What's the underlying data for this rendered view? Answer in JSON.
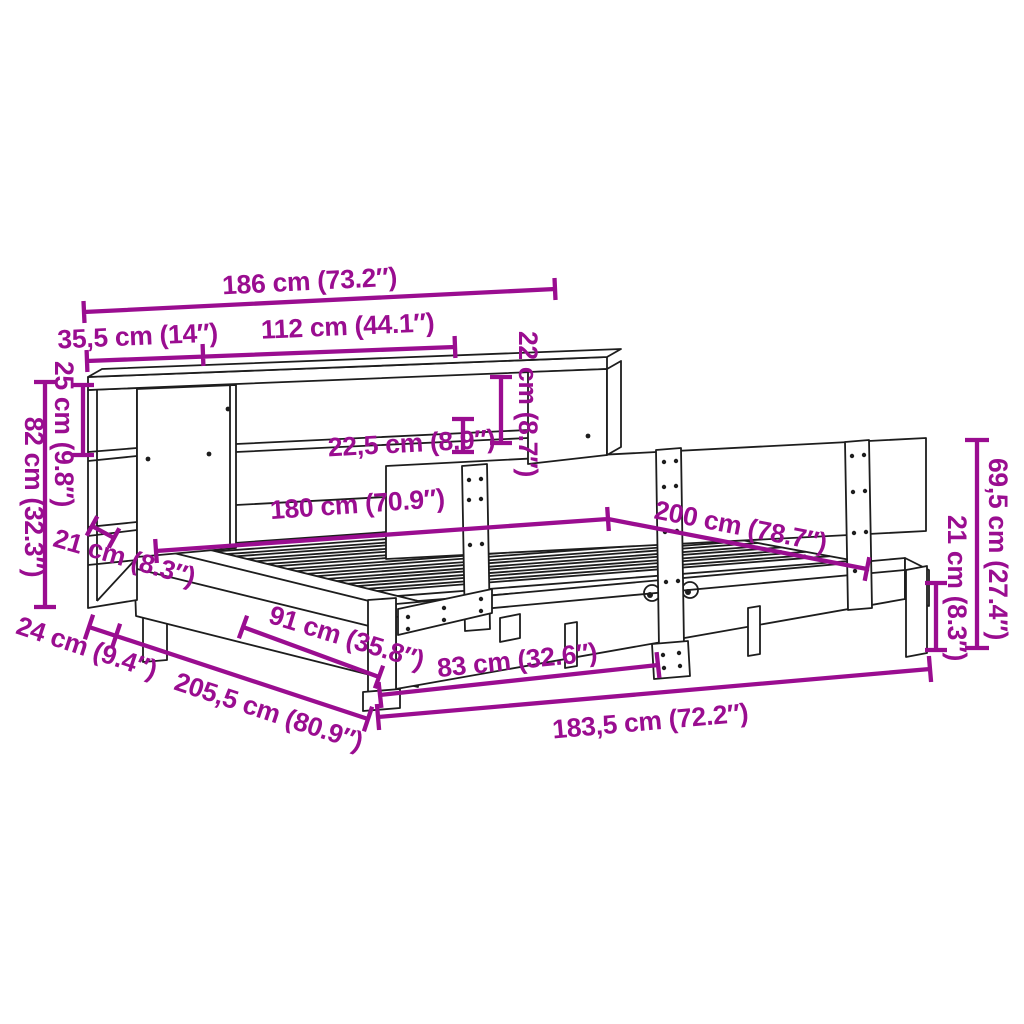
{
  "title": "Bed frame with bookcase headboard - dimension diagram",
  "colors": {
    "dimension_accent": "#9A0D90",
    "line_art": "#1D1D1D",
    "background": "#FFFFFF"
  },
  "dimensions": {
    "headboard_total_width": {
      "label": "186 cm (73.2″)",
      "cm": "186",
      "inches": "73.2"
    },
    "left_shelf_width": {
      "label": "35,5 cm (14″)",
      "cm": "35,5",
      "inches": "14"
    },
    "middle_section_width": {
      "label": "112 cm (44.1″)",
      "cm": "112",
      "inches": "44.1"
    },
    "top_compartment_height": {
      "label": "22 cm (8.7″)",
      "cm": "22",
      "inches": "8.7"
    },
    "shelf_opening_height": {
      "label": "22,5 cm (8.9″)",
      "cm": "22,5",
      "inches": "8.9"
    },
    "cubby_height": {
      "label": "25 cm (9.8″)",
      "cm": "25",
      "inches": "9.8"
    },
    "headboard_height": {
      "label": "82 cm (32.3″)",
      "cm": "82",
      "inches": "32.3"
    },
    "frame_height_left": {
      "label": "21 cm (8.3″)",
      "cm": "21",
      "inches": "8.3"
    },
    "bed_width": {
      "label": "180 cm (70.9″)",
      "cm": "180",
      "inches": "70.9"
    },
    "bed_length": {
      "label": "200 cm (78.7″)",
      "cm": "200",
      "inches": "78.7"
    },
    "backrest_height": {
      "label": "69,5 cm (27.4″)",
      "cm": "69,5",
      "inches": "27.4"
    },
    "leg_height_right": {
      "label": "21 cm (8.3″)",
      "cm": "21",
      "inches": "8.3"
    },
    "headboard_depth": {
      "label": "24 cm (9.4″)",
      "cm": "24",
      "inches": "9.4"
    },
    "total_depth": {
      "label": "205,5 cm (80.9″)",
      "cm": "205,5",
      "inches": "80.9"
    },
    "side_leg_spacing": {
      "label": "91 cm (35.8″)",
      "cm": "91",
      "inches": "35.8"
    },
    "front_leg_spacing": {
      "label": "83 cm (32.6″)",
      "cm": "83",
      "inches": "32.6"
    },
    "frame_bottom_width": {
      "label": "183,5 cm (72.2″)",
      "cm": "183,5",
      "inches": "72.2"
    }
  }
}
